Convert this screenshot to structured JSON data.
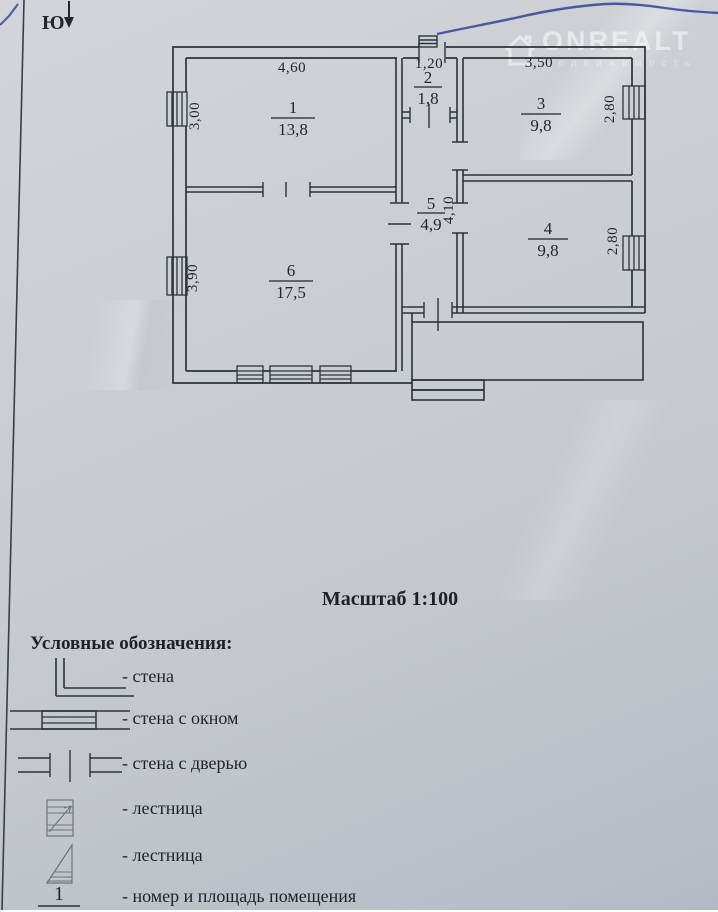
{
  "compass": {
    "label": "Ю"
  },
  "watermark": {
    "brand": "ONREALT",
    "subtext": "недвижимость"
  },
  "scale": {
    "text": "Масштаб 1:100"
  },
  "plan": {
    "rooms": {
      "r1": {
        "number": "1",
        "area": "13,8"
      },
      "r2": {
        "number": "2",
        "area": "1,8"
      },
      "r3": {
        "number": "3",
        "area": "9,8"
      },
      "r4": {
        "number": "4",
        "area": "9,8"
      },
      "r5": {
        "number": "5",
        "area": "4,9"
      },
      "r6": {
        "number": "6",
        "area": "17,5"
      }
    },
    "dimensions": {
      "top_room1": "4,60",
      "top_room2": "1,20",
      "top_room3": "3,50",
      "left_room1": "3,00",
      "left_room6": "3,90",
      "right_room3": "2,80",
      "right_room4": "2,80",
      "corridor": "4,10"
    }
  },
  "legend": {
    "title": "Условные обозначения:",
    "items": [
      {
        "label": "- стена"
      },
      {
        "label": "- стена с окном"
      },
      {
        "label": "- стена с дверью"
      },
      {
        "label": "- лестница"
      },
      {
        "label": "- лестница"
      },
      {
        "label": "- номер и площадь помещения"
      }
    ],
    "sample_number": "1"
  }
}
